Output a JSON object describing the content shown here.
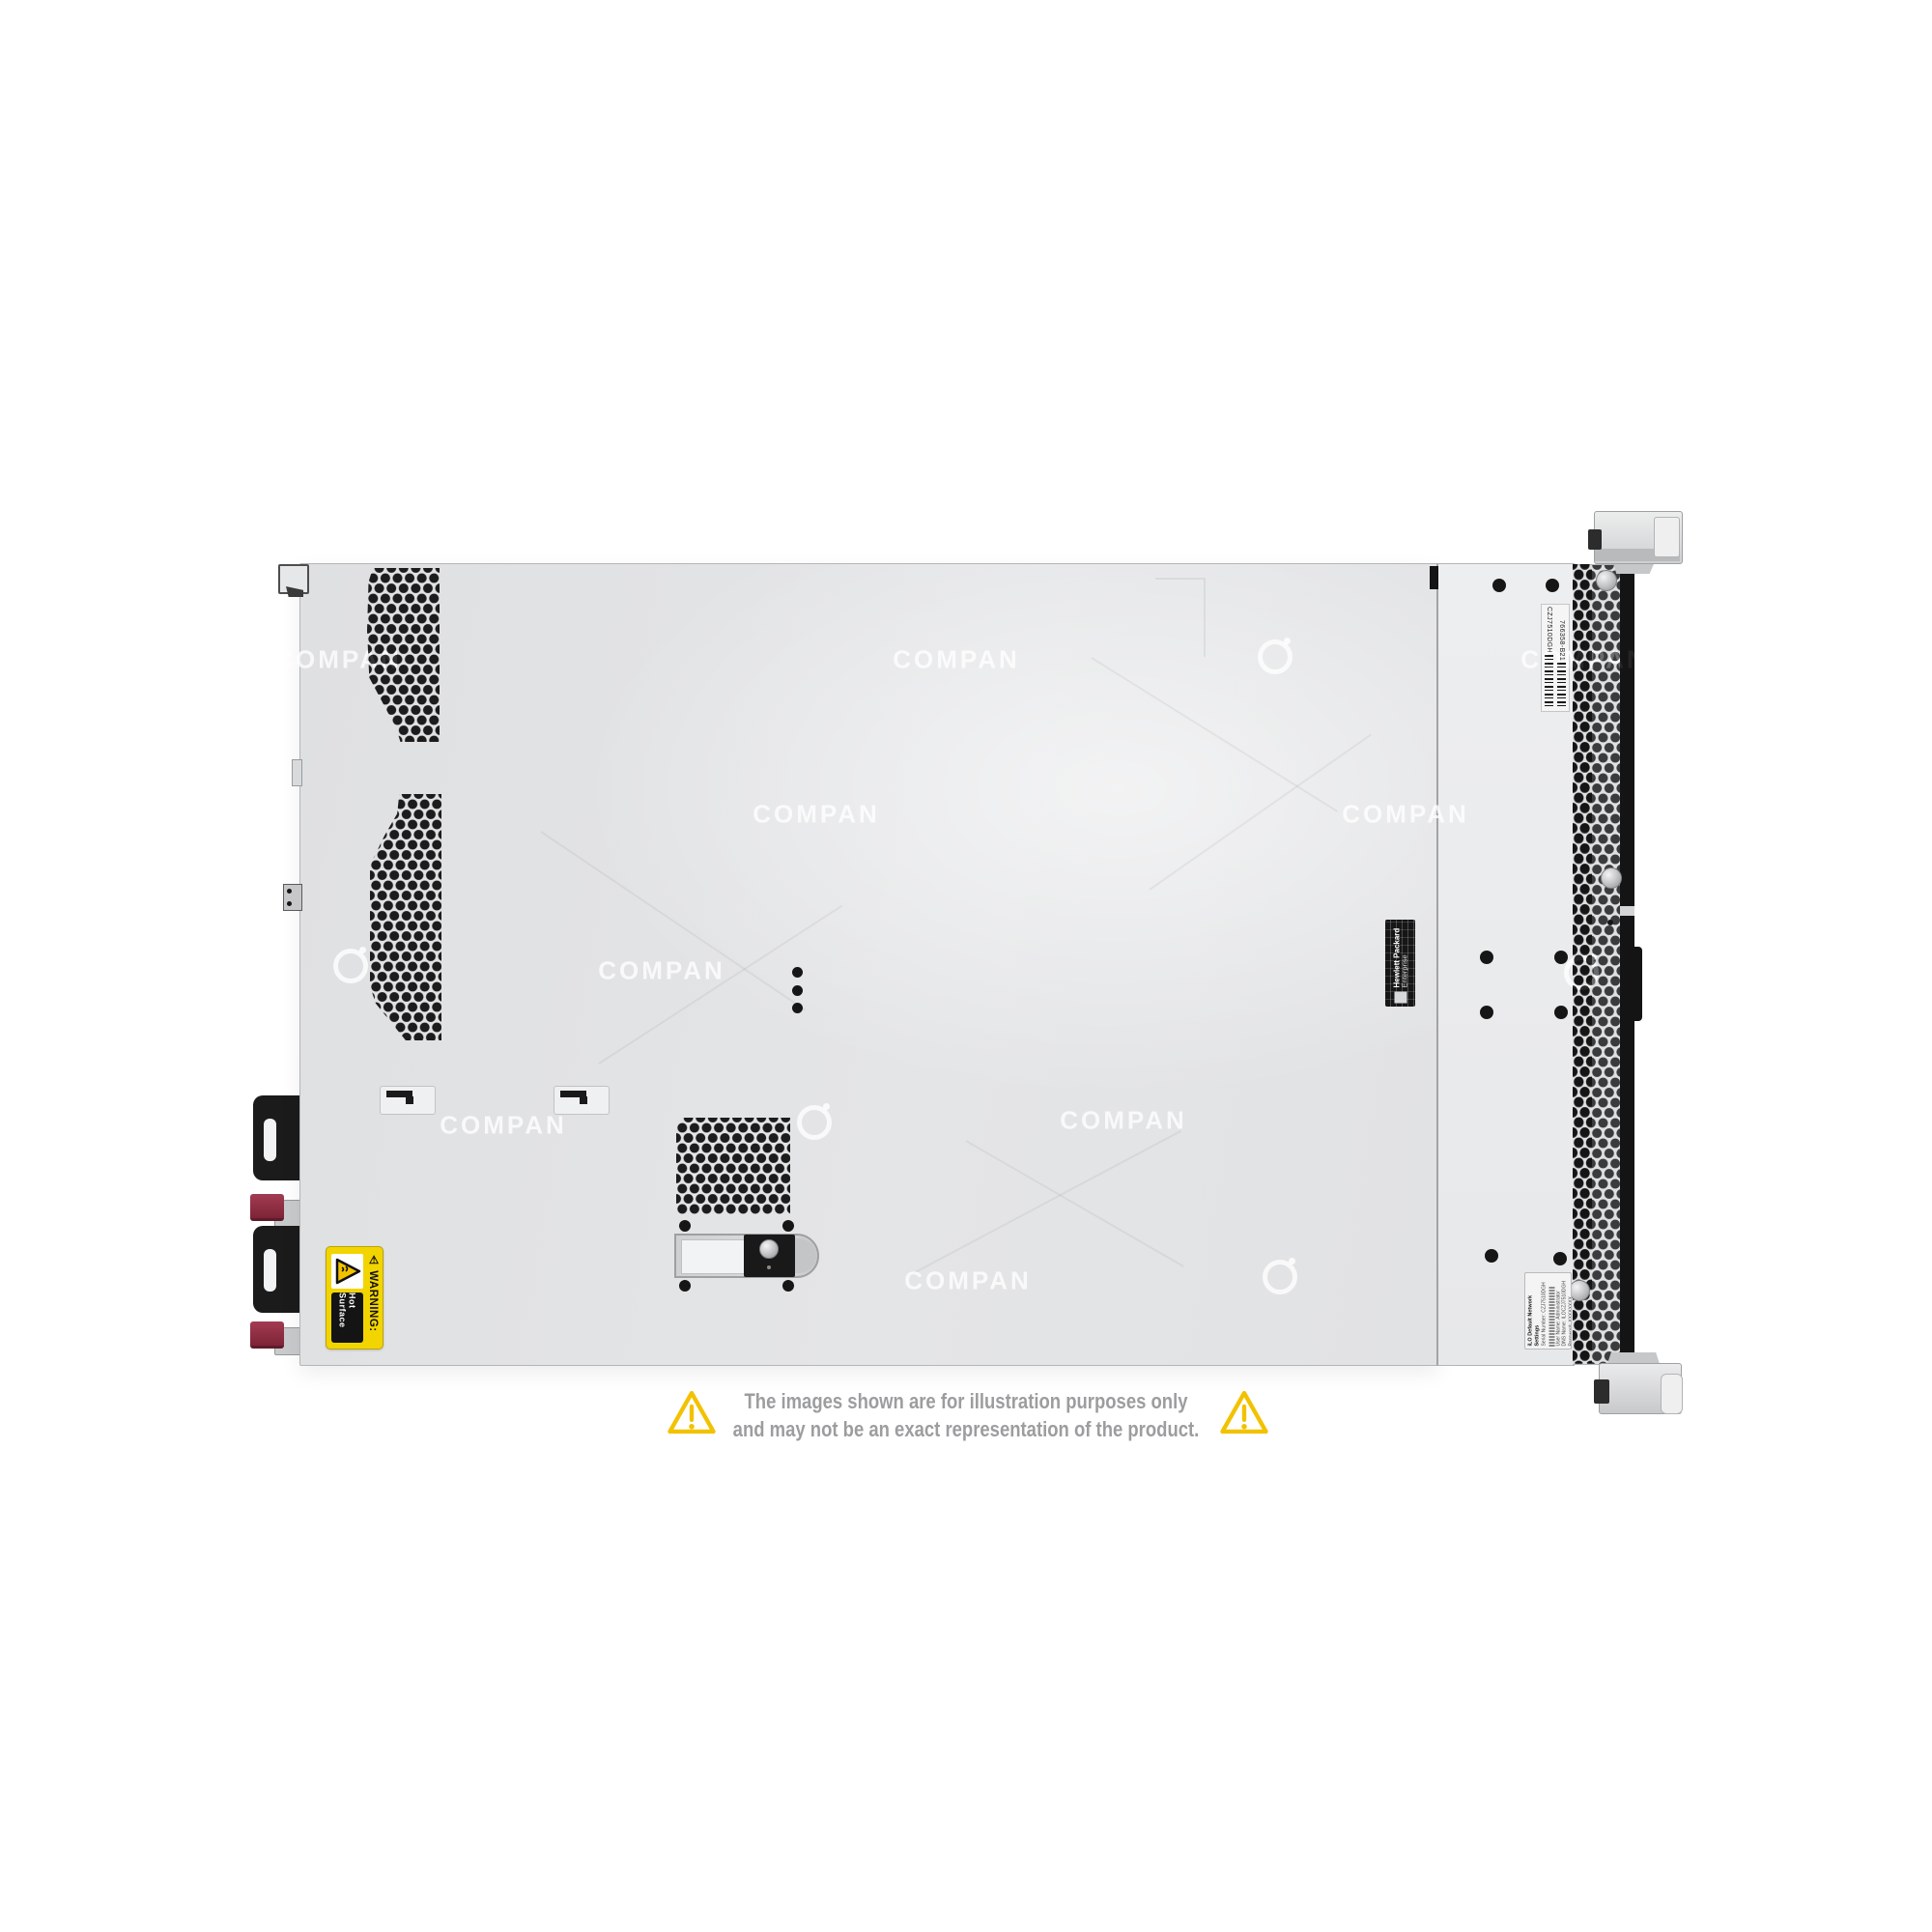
{
  "page": {
    "background_color": "#ffffff"
  },
  "watermark": {
    "text": "COMPAN"
  },
  "disclaimer": {
    "line1": "The images shown are for illustration purposes only",
    "line2": "and may not be an exact representation of the product.",
    "text_color": "#9c9d9e",
    "triangle_color": "#f2c200"
  },
  "server_labels": {
    "warning_label": {
      "heading": "⚠ WARNING:",
      "text": "Hot Surface",
      "bg_color": "#f2d500"
    },
    "hpe_label": {
      "line1": "Hewlett Packard",
      "line2": "Enterprise"
    },
    "service_label": {
      "serial": "CZJ7510DGH",
      "part_number": "766358-B21"
    },
    "ilo_label": {
      "title": "iLO Default Network Settings",
      "lines": [
        "Serial Number: CZJ7510DGH",
        "User Name: Administrator",
        "DNS Name: ILOCZJ7510DGH",
        "Password: XXXXXXXX"
      ]
    }
  }
}
